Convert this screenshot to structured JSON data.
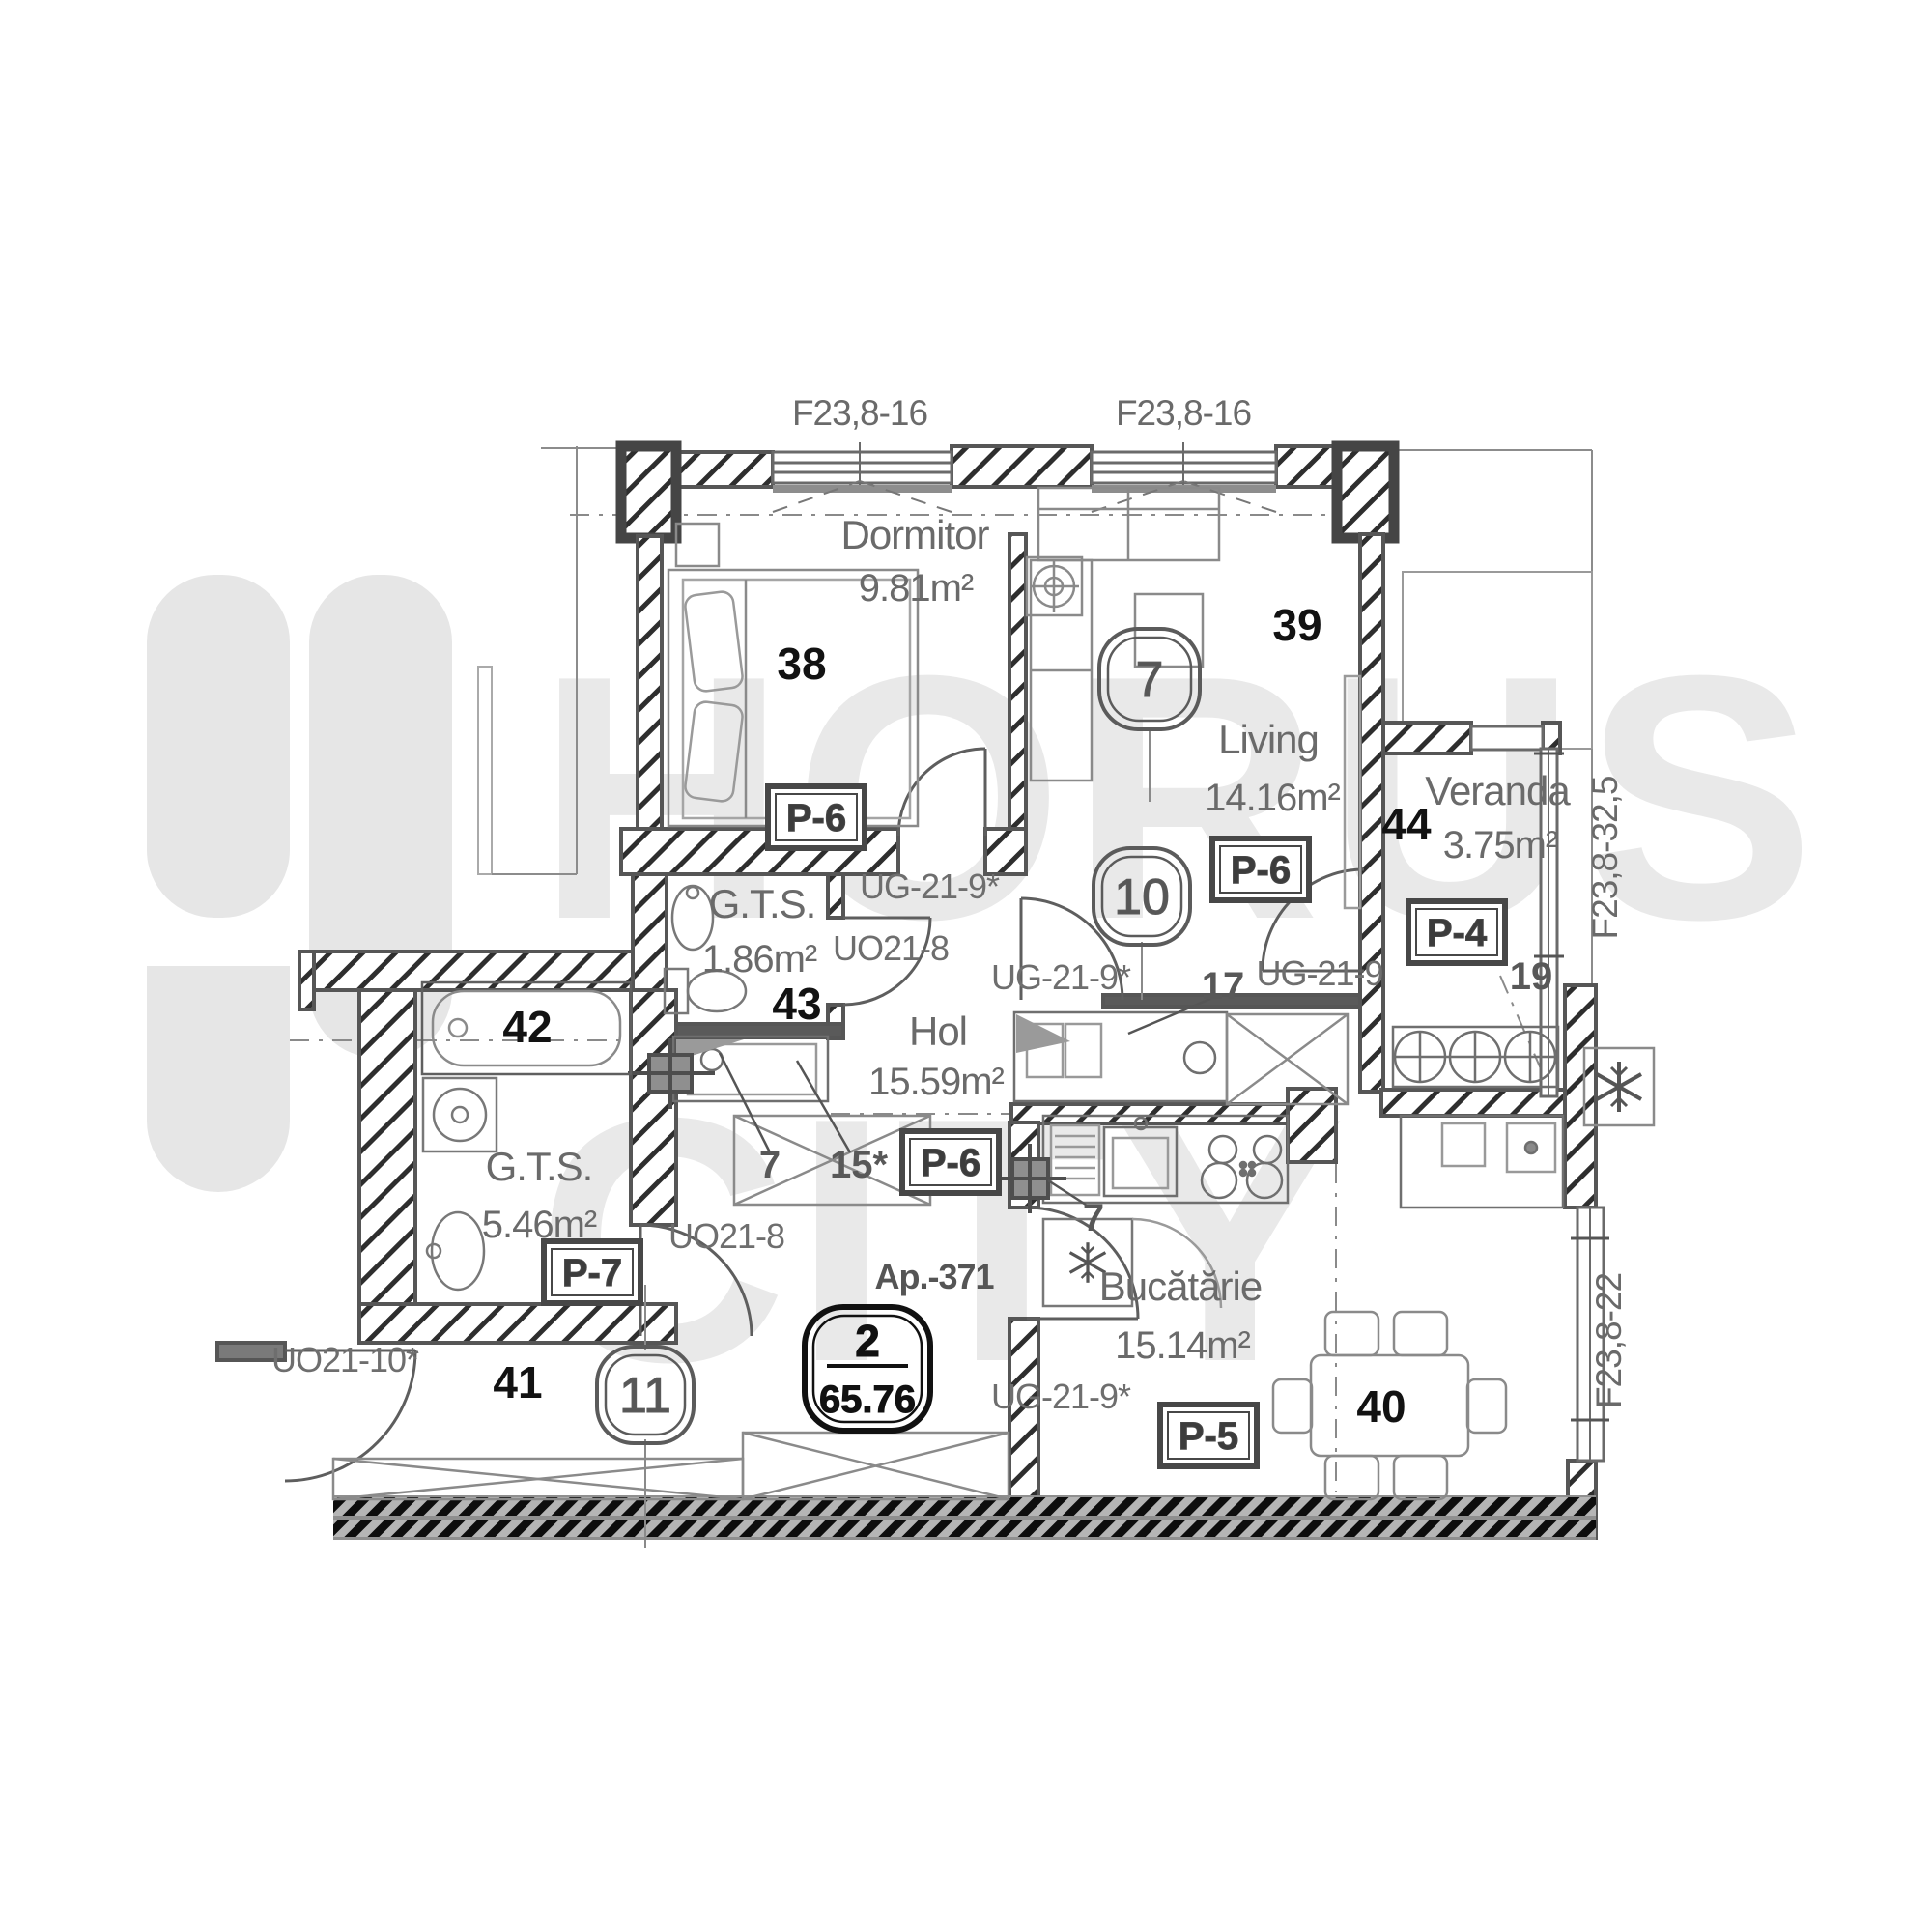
{
  "watermark": {
    "word1": "HORUS",
    "word2": "CITY"
  },
  "windows": {
    "top_left": "F23,8-16",
    "top_right": "F23,8-16",
    "veranda_right": "F23,8-32,5",
    "kitchen_right": "F23,8-22"
  },
  "rooms": {
    "dormitor": {
      "name": "Dormitor",
      "area": "9.81m²",
      "number": "38",
      "finish": "P-6"
    },
    "living": {
      "name": "Living",
      "area": "14.16m²",
      "number": "39",
      "finish": "P-6"
    },
    "veranda": {
      "name": "Veranda",
      "area": "3.75m²",
      "number": "44",
      "finish": "P-4",
      "item": "19"
    },
    "gts_small": {
      "name": "G.T.S.",
      "area": "1.86m²",
      "number": "43"
    },
    "hol": {
      "name": "Hol",
      "area": "15.59m²",
      "finish": "P-6",
      "item_a": "7",
      "item_b": "15*"
    },
    "gts_big": {
      "name": "G.T.S.",
      "area": "5.46m²",
      "number": "42",
      "finish": "P-7"
    },
    "entry": {
      "number": "41"
    },
    "kitchen": {
      "name": "Bucătărie",
      "area": "15.14m²",
      "finish": "P-5",
      "item": "7",
      "counter_number": "17",
      "dining_number": "40"
    }
  },
  "doors": {
    "dormitor_door": "UG-21-9*",
    "gts_small_door": "UO21-8",
    "living_door": "UG-21-9*",
    "veranda_door": "UG-21-9",
    "kitchen_door": "UG-21-9*",
    "gts_big_door": "UO21-8",
    "entry_door": "UO21-10*"
  },
  "stamps": {
    "circle_living": "7",
    "circle_hol": "10",
    "circle_entry": "11",
    "apartment_label": "Ap.-371",
    "apartment_rooms": "2",
    "apartment_area": "65.76"
  }
}
